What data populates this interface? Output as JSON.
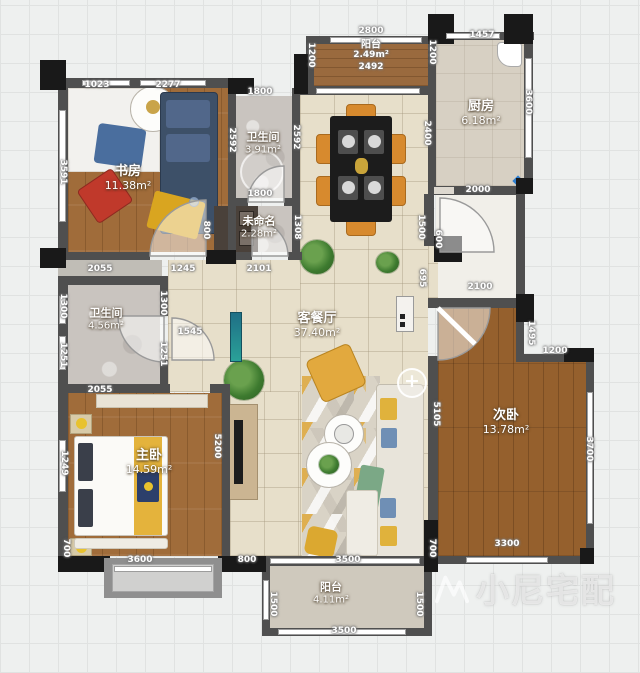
{
  "watermark": {
    "text": "小尼宅配"
  },
  "ui": {
    "plus": "+"
  },
  "rooms": {
    "study": {
      "name": "书房",
      "area": "11.38m²"
    },
    "bath_top": {
      "name": "卫生间",
      "area": "3.91m²"
    },
    "balcony_top": {
      "name": "阳台",
      "area": "2.49m²"
    },
    "kitchen": {
      "name": "厨房",
      "area": "6.18m²"
    },
    "unnamed": {
      "name": "未命名",
      "area": "2.28m²"
    },
    "bath_mid": {
      "name": "卫生间",
      "area": "4.56m²"
    },
    "living": {
      "name": "客餐厅",
      "area": "37.40m²"
    },
    "master": {
      "name": "主卧",
      "area": "14.59m²"
    },
    "second": {
      "name": "次卧",
      "area": "13.78m²"
    },
    "balcony_bottom": {
      "name": "阳台",
      "area": "4.11m²"
    }
  },
  "dims": {
    "study_top_a": "1023",
    "study_top_b": "2277",
    "study_left": "3591",
    "bath_top_w1": "1800",
    "bath_top_w2": "1800",
    "bath_top_h_left": "2592",
    "bath_top_h_right": "2592",
    "balcony_top_w": "2800",
    "balcony_top_w2": "2492",
    "balcony_top_h_left": "1200",
    "balcony_top_h_right": "1200",
    "kitchen_top": "1457",
    "kitchen_right": "3600",
    "kitchen_bottom": "2000",
    "dining_right": "2400",
    "row_mid_a": "2055",
    "row_mid_b": "1245",
    "row_mid_c": "2101",
    "unnamed_left": "800",
    "unnamed_right": "1308",
    "entry_v1": "1500",
    "entry_v2": "600",
    "entry_v3": "695",
    "second_top": "2100",
    "bath_mid_left_a": "1300",
    "bath_mid_left_b": "1251",
    "bath_mid_bottom": "2055",
    "hall_right_a": "1300",
    "hall_right_b": "1251",
    "master_door": "1545",
    "master_left_a": "1249",
    "master_left_b": "700",
    "master_bottom": "3600",
    "master_right": "5200",
    "bay_right": "800",
    "second_left": "5105",
    "second_notch_v": "1495",
    "second_notch_h": "1200",
    "second_right": "3700",
    "second_bottom": "3300",
    "second_wall_left": "700",
    "balcony_bot_top": "3500",
    "balcony_bot_left": "1500",
    "balcony_bot_right": "1500",
    "balcony_bot_bottom": "3500"
  }
}
